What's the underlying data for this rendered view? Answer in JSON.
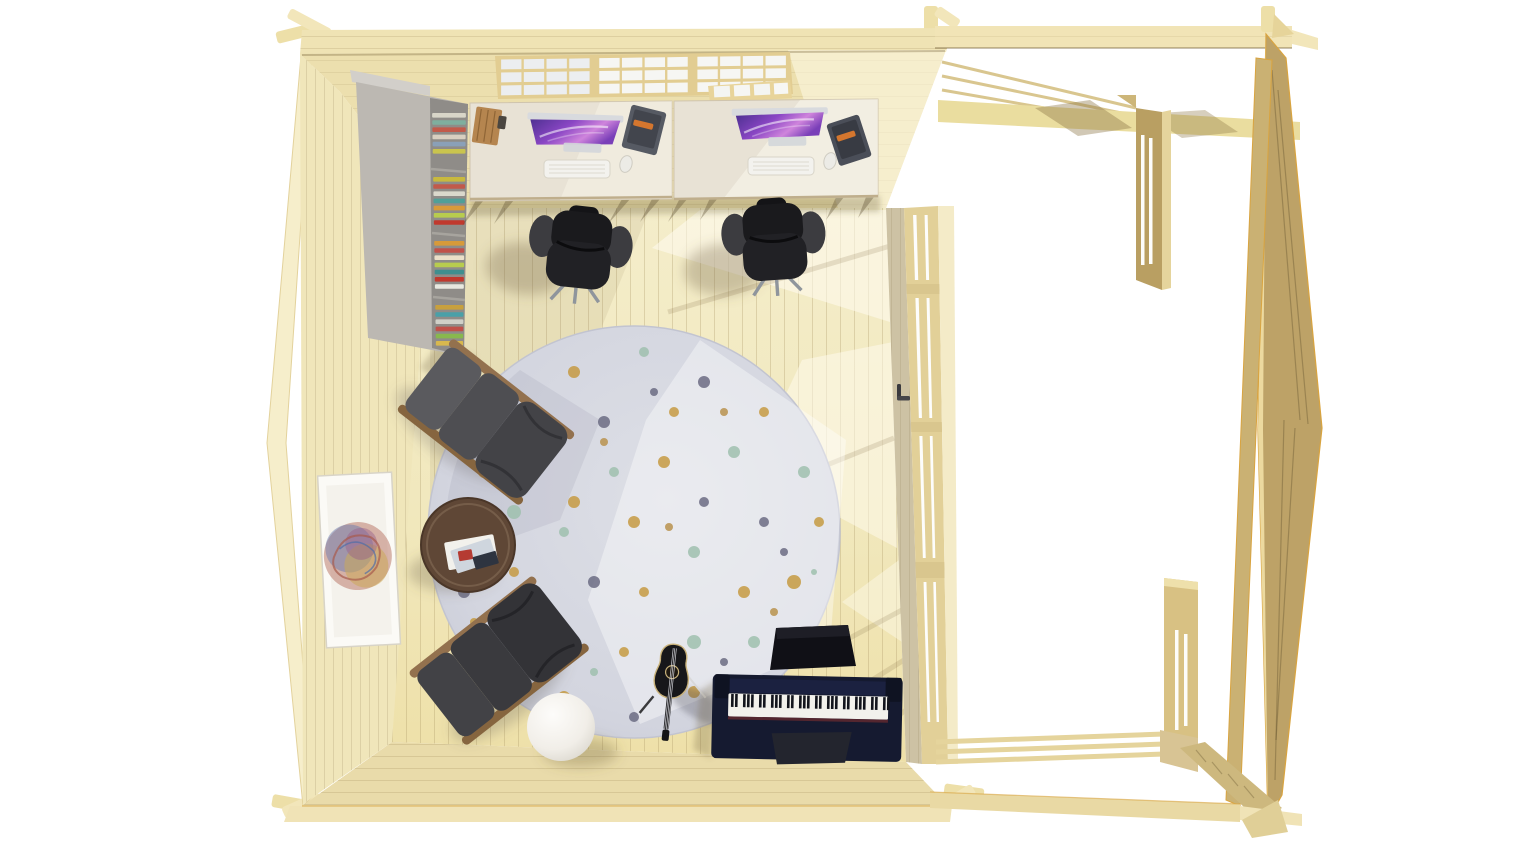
{
  "meta": {
    "title": "Top-down 3D architectural render of a log-cabin garden office with open veranda",
    "background": "#ffffff",
    "sun_direction": "upper-right"
  },
  "palette": {
    "roof_band": "#efe3b4",
    "wall_face": "#ecdfae",
    "wall_left": "#f0e6ba",
    "wall_bottom": "#e9dbaa",
    "wall_outer_strip": "#f4ebc8",
    "floor_light": "#f4edca",
    "floor_warm": "#eee0a8",
    "right_wall_inner": "#cdc2a4",
    "right_wall_frame": "#e2d098",
    "pergola_light": "#f1e4b6",
    "pergola_beam": "#eaddA2",
    "pergola_dark_face": "#b89e60",
    "pergola_post": "#c9b072",
    "desk_wood": "#e8e2d5",
    "desk_sunlit": "#f4efe5",
    "bookshelf_gray": "#bcb8b2",
    "chair_black": "#1a1a1d",
    "armrest_gray": "#3c3c40",
    "leather_gray": "#4a4a4e",
    "leather_dark": "#37373b",
    "wood_frame": "#93714e",
    "table_wood": "#5f4736",
    "rug_base": "#d3d5df",
    "rug_shade": "#c3c6d2",
    "rug_sun": "#eceded",
    "piano_navy": "#151a30",
    "piano_keys_white": "#f2f1ec",
    "piano_keys_black": "#12141c",
    "lamp_white": "#f7f5f1",
    "screen_purple_1": "#4b2f8f",
    "screen_purple_2": "#8a46c4",
    "screen_purple_3": "#cf84dc",
    "organizer_dark": "#565a63",
    "organizer_label": "#d4762e",
    "box_wood": "#b5854f",
    "shadow_warm": "rgba(120,100,60,0.30)"
  },
  "scene": {
    "areas": [
      {
        "name": "office-room",
        "kind": "enclosed cabin room",
        "contents": "two desks, two office chairs, bookshelf, rug, two recliners, coffee table, guitar, floor lamp, digital piano"
      },
      {
        "name": "veranda",
        "kind": "open pergola frame",
        "contents": "posts, beams, bottom rails, no floor rendered"
      }
    ],
    "furniture": [
      {
        "name": "bookshelf",
        "kind": "gray shelving unit with colorful books",
        "center": [
          412,
          220
        ]
      },
      {
        "name": "desk-left",
        "kind": "whitewashed wood desk",
        "center": [
          571,
          150
        ]
      },
      {
        "name": "desk-right",
        "kind": "whitewashed wood desk",
        "center": [
          776,
          150
        ]
      },
      {
        "name": "imac-left",
        "kind": "monitor with purple nebula wallpaper",
        "center": [
          575,
          131
        ]
      },
      {
        "name": "imac-right",
        "kind": "monitor with purple nebula wallpaper",
        "center": [
          780,
          126
        ]
      },
      {
        "name": "office-chair-left",
        "kind": "black swivel task chair",
        "center": [
          580,
          250
        ]
      },
      {
        "name": "office-chair-right",
        "kind": "black swivel task chair",
        "center": [
          774,
          242
        ]
      },
      {
        "name": "round-rug",
        "kind": "speckled terrazzo-pattern rug",
        "center": [
          634,
          532
        ],
        "radius": 206
      },
      {
        "name": "recliner-top",
        "kind": "gray leather recliner with wood rails",
        "center": [
          486,
          422
        ]
      },
      {
        "name": "recliner-bottom",
        "kind": "dark leather recliner with wood rails",
        "center": [
          500,
          660
        ]
      },
      {
        "name": "coffee-table",
        "kind": "round walnut table with magazines",
        "center": [
          468,
          545
        ]
      },
      {
        "name": "acoustic-guitar",
        "kind": "black guitar on stand",
        "center": [
          670,
          695
        ]
      },
      {
        "name": "floor-lamp-sphere",
        "kind": "white globe lamp",
        "center": [
          561,
          727
        ]
      },
      {
        "name": "piano-bench",
        "kind": "black bench",
        "center": [
          812,
          648
        ]
      },
      {
        "name": "digital-piano",
        "kind": "navy upright digital piano",
        "center": [
          807,
          717
        ]
      },
      {
        "name": "framed-artwork",
        "kind": "white frame, multicolor scribble art",
        "center": [
          359,
          559
        ]
      }
    ]
  },
  "room": {
    "top_window_band": {
      "sections": 3,
      "cols_per_section": 4,
      "rows": 3
    },
    "right_wall_openings": [
      [
        215,
        280
      ],
      [
        298,
        418
      ],
      [
        436,
        558
      ],
      [
        582,
        722
      ]
    ],
    "door_handle": true
  },
  "bookshelf": {
    "shelf_y_ranges": [
      [
        108,
        166
      ],
      [
        172,
        230
      ],
      [
        236,
        294
      ],
      [
        300,
        350
      ]
    ],
    "shelves": [
      [
        "#d8d5c8",
        "#7fae9e",
        "#c25a4a",
        "#d8cfc0",
        "#8aa0b8",
        "#c9c44e"
      ],
      [
        "#c8b93e",
        "#c25a4a",
        "#dad8cc",
        "#4f9f98",
        "#d79a3a",
        "#b8cc4e",
        "#c0392e"
      ],
      [
        "#d79a3a",
        "#c0514a",
        "#eadfc8",
        "#b8cc4e",
        "#3f8f8f",
        "#c0392e",
        "#e8e8e0"
      ],
      [
        "#c8a03e",
        "#4aa0a8",
        "#d0d0c8",
        "#c0514a",
        "#88b84e",
        "#d8b84e"
      ]
    ]
  },
  "rug": {
    "cx": 634,
    "cy": 532,
    "r": 206,
    "dot_colors": [
      "#c59a42",
      "#9fbfae",
      "#6b6b82",
      "#b8924e",
      "#8a93a8"
    ],
    "dots": [
      [
        -150,
        -60,
        6,
        0
      ],
      [
        -110,
        -120,
        5,
        2
      ],
      [
        -60,
        -160,
        6,
        0
      ],
      [
        10,
        -180,
        5,
        1
      ],
      [
        70,
        -150,
        6,
        2
      ],
      [
        130,
        -120,
        5,
        0
      ],
      [
        170,
        -60,
        6,
        1
      ],
      [
        185,
        -10,
        5,
        0
      ],
      [
        160,
        50,
        7,
        0
      ],
      [
        120,
        110,
        6,
        1
      ],
      [
        60,
        160,
        6,
        0
      ],
      [
        0,
        185,
        5,
        2
      ],
      [
        -70,
        165,
        6,
        0
      ],
      [
        -130,
        120,
        5,
        1
      ],
      [
        -170,
        60,
        6,
        2
      ],
      [
        -185,
        0,
        5,
        0
      ],
      [
        -120,
        -20,
        7,
        1
      ],
      [
        -90,
        -80,
        5,
        0
      ],
      [
        -30,
        -110,
        6,
        2
      ],
      [
        40,
        -120,
        5,
        0
      ],
      [
        100,
        -80,
        6,
        1
      ],
      [
        130,
        -10,
        5,
        2
      ],
      [
        110,
        60,
        6,
        0
      ],
      [
        60,
        110,
        7,
        1
      ],
      [
        -10,
        120,
        5,
        0
      ],
      [
        -80,
        90,
        6,
        2
      ],
      [
        -120,
        40,
        5,
        0
      ],
      [
        -60,
        -30,
        6,
        0
      ],
      [
        -20,
        -60,
        5,
        1
      ],
      [
        30,
        -70,
        6,
        0
      ],
      [
        70,
        -30,
        5,
        2
      ],
      [
        60,
        20,
        6,
        1
      ],
      [
        10,
        60,
        5,
        0
      ],
      [
        -40,
        50,
        6,
        2
      ],
      [
        -70,
        0,
        5,
        1
      ],
      [
        0,
        -10,
        6,
        0
      ],
      [
        35,
        -5,
        4,
        3
      ],
      [
        -30,
        -90,
        4,
        3
      ],
      [
        90,
        -120,
        4,
        3
      ],
      [
        150,
        20,
        4,
        2
      ],
      [
        90,
        130,
        4,
        2
      ],
      [
        -40,
        140,
        4,
        1
      ],
      [
        -140,
        -90,
        4,
        1
      ],
      [
        -160,
        90,
        4,
        0
      ],
      [
        20,
        -140,
        4,
        2
      ],
      [
        180,
        40,
        3,
        1
      ],
      [
        -100,
        140,
        4,
        0
      ],
      [
        140,
        80,
        4,
        3
      ]
    ]
  },
  "piano": {
    "white_key_slots": 40,
    "black_key_pattern": [
      0,
      1,
      3,
      4,
      5
    ]
  }
}
